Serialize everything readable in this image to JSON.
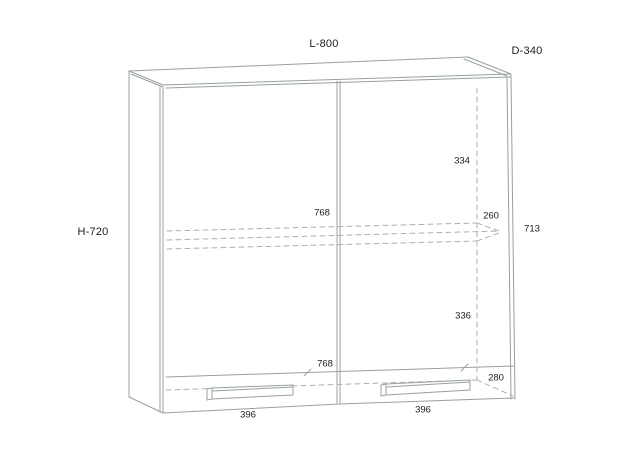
{
  "drawing": {
    "type": "technical line drawing",
    "subject": "two-door wall cabinet, front perspective view with hidden (dashed) shelf and interior edges",
    "labels": {
      "width": "L-800",
      "depth": "D-340",
      "height": "H-720"
    },
    "dims": {
      "interior_upper_height": "334",
      "shelf_width": "768",
      "shelf_depth": "260",
      "door_height": "713",
      "interior_lower_height": "336",
      "bottom_width": "768",
      "bottom_depth": "280",
      "left_door_width": "396",
      "right_door_width": "396"
    },
    "colors": {
      "background": "#ffffff",
      "line": "#98a0a0",
      "dashed_line": "#aab0b0",
      "text": "#1c1c1c"
    }
  }
}
